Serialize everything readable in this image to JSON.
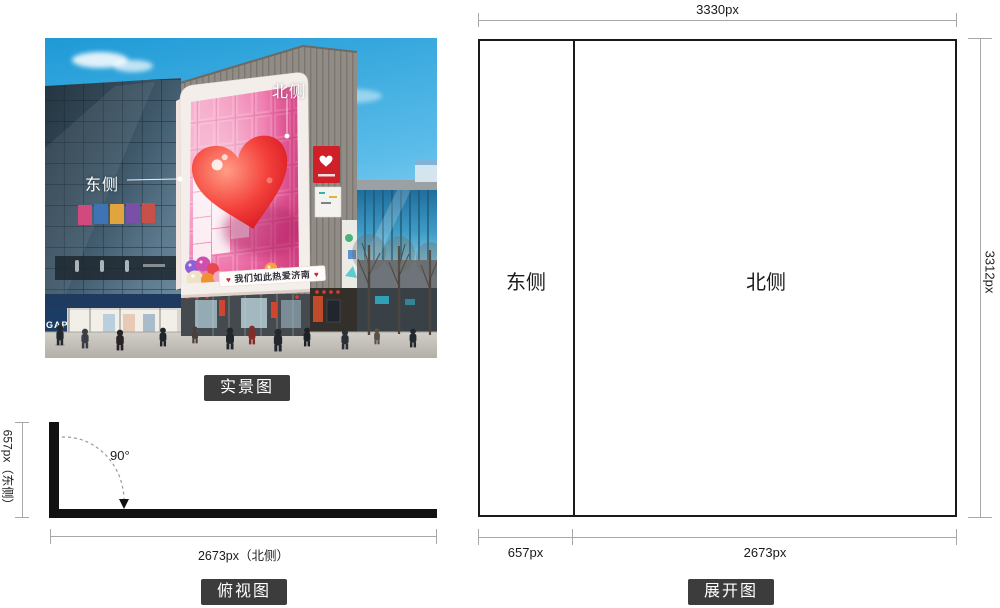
{
  "photo": {
    "caption": "实景图",
    "north_label": "北侧",
    "east_label": "东侧",
    "banner": {
      "heart": "♥",
      "text": "我们如此热爱济南"
    },
    "gap_sign": "GAP"
  },
  "topview": {
    "caption": "俯视图",
    "angle_label": "90°",
    "left_dim": "657px（东侧）",
    "bottom_dim": "2673px（北侧）"
  },
  "unfold": {
    "caption": "展开图",
    "top_dim": "3330px",
    "right_dim": "3312px",
    "bottom_left_dim": "657px",
    "bottom_right_dim": "2673px",
    "east_label": "东侧",
    "north_label": "北侧"
  },
  "colors": {
    "caption_bg": "#3c3c3c",
    "dim_line": "#a8a8a8",
    "screen_pink": "#ec62a0",
    "heart_red": "#d91c25",
    "sky_blue": "#1e9ad6"
  }
}
